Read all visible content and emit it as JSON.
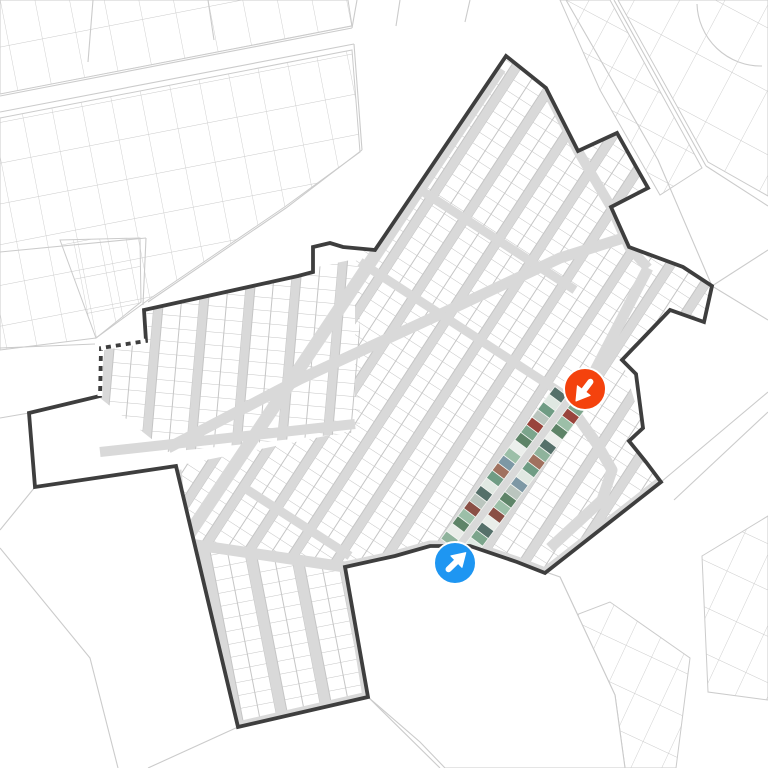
{
  "canvas": {
    "w": 768,
    "h": 768
  },
  "colors": {
    "bg": "#ffffff",
    "outside_line": "#cbcbcb",
    "parcel_line": "#c5c5c5",
    "street": "#d9d9d9",
    "boundary": "#3e3e3e",
    "marker_red": "#f4420d",
    "marker_blue": "#1e96f2",
    "photo_sep": "#f2f4f1"
  },
  "background": {
    "roads": [
      {
        "pts": [
          [
            0,
            96
          ],
          [
            352,
            28
          ]
        ]
      },
      {
        "pts": [
          [
            0,
            112
          ],
          [
            354,
            44
          ]
        ]
      },
      {
        "pts": [
          [
            93,
            0
          ],
          [
            88,
            62
          ]
        ]
      },
      {
        "pts": [
          [
            208,
            0
          ],
          [
            214,
            40
          ]
        ]
      },
      {
        "pts": [
          [
            352,
            28
          ],
          [
            357,
            0
          ]
        ]
      },
      {
        "pts": [
          [
            354,
            44
          ],
          [
            362,
            150
          ]
        ]
      },
      {
        "pts": [
          [
            362,
            150
          ],
          [
            286,
            208
          ],
          [
            148,
            302
          ]
        ]
      },
      {
        "pts": [
          [
            566,
            0
          ],
          [
            658,
            160
          ],
          [
            712,
            286
          ]
        ]
      },
      {
        "pts": [
          [
            614,
            0
          ],
          [
            706,
            166
          ]
        ]
      },
      {
        "pts": [
          [
            706,
            166
          ],
          [
            768,
            206
          ]
        ]
      },
      {
        "pts": [
          [
            712,
            286
          ],
          [
            768,
            320
          ]
        ]
      },
      {
        "pts": [
          [
            712,
            286
          ],
          [
            768,
            250
          ]
        ]
      },
      {
        "pts": [
          [
            661,
            482
          ],
          [
            768,
            392
          ]
        ]
      },
      {
        "pts": [
          [
            674,
            500
          ],
          [
            768,
            412
          ]
        ]
      },
      {
        "pts": [
          [
            560,
            577
          ],
          [
            615,
            695
          ],
          [
            625,
            768
          ]
        ]
      },
      {
        "pts": [
          [
            368,
            697
          ],
          [
            440,
            768
          ]
        ]
      },
      {
        "pts": [
          [
            238,
            727
          ],
          [
            148,
            768
          ]
        ]
      },
      {
        "pts": [
          [
            0,
            252
          ],
          [
            146,
            238
          ]
        ]
      },
      {
        "pts": [
          [
            146,
            238
          ],
          [
            143,
            305
          ]
        ]
      },
      {
        "pts": [
          [
            0,
            348
          ],
          [
            95,
            344
          ]
        ]
      },
      {
        "pts": [
          [
            0,
            530
          ],
          [
            35,
            487
          ]
        ]
      },
      {
        "pts": [
          [
            0,
            548
          ],
          [
            90,
            658
          ],
          [
            118,
            768
          ]
        ]
      },
      {
        "pts": [
          [
            29,
            413
          ],
          [
            0,
            418
          ]
        ]
      },
      {
        "pts": [
          [
            400,
            0
          ],
          [
            396,
            26
          ]
        ]
      },
      {
        "pts": [
          [
            470,
            0
          ],
          [
            465,
            22
          ]
        ]
      }
    ],
    "arcs": [
      {
        "d": "M 697 4 A 64 64 0 0 0 762 66"
      }
    ],
    "patches": [
      {
        "poly": [
          [
            0,
            0
          ],
          [
            348,
            0
          ],
          [
            352,
            26
          ],
          [
            0,
            94
          ]
        ],
        "rot": -11,
        "cw": 34,
        "ch": 46
      },
      {
        "poly": [
          [
            0,
            118
          ],
          [
            352,
            50
          ],
          [
            360,
            152
          ],
          [
            286,
            206
          ],
          [
            148,
            300
          ],
          [
            96,
            338
          ],
          [
            0,
            350
          ]
        ],
        "rot": -11,
        "cw": 30,
        "ch": 40
      },
      {
        "poly": [
          [
            560,
            0
          ],
          [
            610,
            0
          ],
          [
            702,
            168
          ],
          [
            660,
            195
          ],
          [
            600,
            90
          ]
        ],
        "rot": 28,
        "cw": 26,
        "ch": 38
      },
      {
        "poly": [
          [
            618,
            0
          ],
          [
            768,
            0
          ],
          [
            768,
            196
          ],
          [
            708,
            162
          ]
        ],
        "rot": 28,
        "cw": 40,
        "ch": 56
      },
      {
        "poly": [
          [
            500,
            644
          ],
          [
            610,
            602
          ],
          [
            690,
            658
          ],
          [
            676,
            768
          ],
          [
            505,
            768
          ]
        ],
        "rot": 25,
        "cw": 28,
        "ch": 40
      },
      {
        "poly": [
          [
            702,
            556
          ],
          [
            768,
            516
          ],
          [
            768,
            700
          ],
          [
            708,
            692
          ]
        ],
        "rot": 25,
        "cw": 30,
        "ch": 42
      },
      {
        "poly": [
          [
            60,
            240
          ],
          [
            140,
            238
          ],
          [
            141,
            302
          ],
          [
            96,
            338
          ]
        ],
        "rot": -11,
        "cw": 26,
        "ch": 36
      }
    ],
    "outlined": [
      {
        "poly": [
          [
            345,
            567
          ],
          [
            430,
            546
          ],
          [
            470,
            546
          ],
          [
            517,
            562
          ],
          [
            560,
            577
          ],
          [
            615,
            695
          ],
          [
            625,
            768
          ],
          [
            445,
            768
          ],
          [
            420,
            742
          ],
          [
            368,
            697
          ]
        ]
      }
    ]
  },
  "site": {
    "boundary": [
      [
        506,
        56
      ],
      [
        546,
        88
      ],
      [
        578,
        151
      ],
      [
        617,
        133
      ],
      [
        648,
        188
      ],
      [
        611,
        207
      ],
      [
        629,
        247
      ],
      [
        683,
        267
      ],
      [
        712,
        286
      ],
      [
        704,
        322
      ],
      [
        670,
        310
      ],
      [
        622,
        360
      ],
      [
        636,
        374
      ],
      [
        643,
        428
      ],
      [
        629,
        441
      ],
      [
        646,
        462
      ],
      [
        661,
        482
      ],
      [
        545,
        573
      ],
      [
        517,
        562
      ],
      [
        470,
        546
      ],
      [
        430,
        546
      ],
      [
        395,
        556
      ],
      [
        345,
        567
      ],
      [
        368,
        697
      ],
      [
        238,
        727
      ],
      [
        176,
        466
      ],
      [
        35,
        487
      ],
      [
        29,
        413
      ],
      [
        100,
        396
      ],
      [
        101,
        348
      ],
      [
        146,
        341
      ],
      [
        144,
        310
      ],
      [
        298,
        276
      ],
      [
        313,
        272
      ],
      [
        313,
        247
      ],
      [
        330,
        243
      ],
      [
        343,
        247
      ],
      [
        375,
        250
      ]
    ],
    "dashed_edges": [
      [
        [
          100,
          396
        ],
        [
          101,
          348
        ]
      ],
      [
        [
          101,
          348
        ],
        [
          146,
          341
        ]
      ]
    ],
    "zones": [
      {
        "name": "zone-left-grid",
        "poly": [
          [
            95,
            340
          ],
          [
            148,
            333
          ],
          [
            146,
            303
          ],
          [
            360,
            258
          ],
          [
            360,
            432
          ],
          [
            168,
            452
          ],
          [
            100,
            398
          ]
        ],
        "rot": 95,
        "across": 45,
        "block": 36,
        "rung": 13
      },
      {
        "name": "zone-bottom-grid",
        "poly": [
          [
            183,
            543
          ],
          [
            347,
            567
          ],
          [
            368,
            697
          ],
          [
            238,
            727
          ]
        ],
        "rot": 79,
        "across": 45,
        "block": 34,
        "rung": 13
      },
      {
        "name": "zone-diagonal-grid",
        "poly": [
          [
            355,
            262
          ],
          [
            506,
            56
          ],
          [
            546,
            88
          ],
          [
            578,
            151
          ],
          [
            617,
            133
          ],
          [
            648,
            188
          ],
          [
            611,
            207
          ],
          [
            629,
            247
          ],
          [
            683,
            267
          ],
          [
            712,
            286
          ],
          [
            704,
            322
          ],
          [
            670,
            310
          ],
          [
            622,
            360
          ],
          [
            643,
            428
          ],
          [
            661,
            482
          ],
          [
            545,
            573
          ],
          [
            345,
            567
          ],
          [
            183,
            543
          ],
          [
            176,
            466
          ],
          [
            355,
            430
          ]
        ],
        "rot": -57,
        "across": 39.5,
        "block": 30,
        "rung": 12.5
      }
    ],
    "streets": [
      {
        "name": "main-avenue",
        "pts": [
          [
            500,
            68
          ],
          [
            183,
            543
          ]
        ],
        "w": 13
      },
      {
        "name": "oblique-avenue",
        "pts": [
          [
            168,
            448
          ],
          [
            300,
            379
          ],
          [
            443,
            313
          ],
          [
            560,
            258
          ],
          [
            636,
            234
          ]
        ],
        "w": 11
      },
      {
        "name": "left-cross-street",
        "pts": [
          [
            100,
            452
          ],
          [
            355,
            424
          ]
        ],
        "w": 10
      },
      {
        "name": "cross-street-upper",
        "pts": [
          [
            405,
            180
          ],
          [
            575,
            290
          ]
        ],
        "w": 9
      },
      {
        "name": "cross-street-middle",
        "pts": [
          [
            360,
            262
          ],
          [
            572,
            400
          ]
        ],
        "w": 9
      },
      {
        "name": "cross-street-lower",
        "pts": [
          [
            243,
            487
          ],
          [
            350,
            556
          ]
        ],
        "w": 9
      },
      {
        "name": "south-road",
        "pts": [
          [
            176,
            470
          ],
          [
            183,
            543
          ],
          [
            345,
            567
          ],
          [
            395,
            556
          ],
          [
            430,
            546
          ],
          [
            470,
            546
          ],
          [
            517,
            562
          ],
          [
            545,
            573
          ],
          [
            661,
            482
          ]
        ],
        "w": 11
      },
      {
        "name": "lobe-ring-road",
        "pts": [
          [
            183,
            543
          ],
          [
            238,
            727
          ],
          [
            368,
            697
          ],
          [
            347,
            567
          ]
        ],
        "w": 11
      },
      {
        "name": "east-boundary-street",
        "pts": [
          [
            546,
            88
          ],
          [
            578,
            151
          ],
          [
            611,
            207
          ],
          [
            629,
            247
          ],
          [
            648,
            268
          ]
        ],
        "w": 10
      },
      {
        "name": "east-curved-road",
        "pts": [
          [
            648,
            268
          ],
          [
            585,
            390
          ],
          [
            574,
            412
          ],
          [
            597,
            444
          ],
          [
            612,
            470
          ],
          [
            602,
            500
          ],
          [
            575,
            525
          ],
          [
            550,
            548
          ]
        ],
        "w": 11
      },
      {
        "name": "photo-street",
        "pts": [
          [
            456,
            550
          ],
          [
            570,
            398
          ]
        ],
        "w": 8
      }
    ]
  },
  "photo_strip": {
    "a": [
      456,
      550
    ],
    "b": [
      570,
      398
    ],
    "depth": 15,
    "offset": 4,
    "count": 20,
    "left_colors": [
      "#8fb39c",
      "#e9ede9",
      "#5e8468",
      "#9cbfa8",
      "#8a4f45",
      "#bac5be",
      "#55706a",
      "#e0e8e2",
      "#6f9c84",
      "#a0715f",
      "#7d98a5",
      "#9cbfa8",
      "#ecefec",
      "#5e8468",
      "#7ca58c",
      "#99443c",
      "#bac5be",
      "#6f9c84",
      "#dfe8e2",
      "#55706a"
    ],
    "right_colors": [
      "#6f9c84",
      "#dfe8e2",
      "#7ca58c",
      "#55706a",
      "#e9ede9",
      "#8a4f45",
      "#9cbfa8",
      "#5e8468",
      "#bac5be",
      "#7d98a5",
      "#e0e8e2",
      "#6f9c84",
      "#a0715f",
      "#8fb39c",
      "#55706a",
      "#ecefec",
      "#5e8468",
      "#9cbfa8",
      "#99443c",
      "#7ca58c"
    ]
  },
  "markers": [
    {
      "name": "red-arrow-marker",
      "cx": 585,
      "cy": 389,
      "r": 21,
      "color": "#f4420d",
      "angle": 127
    },
    {
      "name": "blue-arrow-marker",
      "cx": 455,
      "cy": 563,
      "r": 21,
      "color": "#1e96f2",
      "angle": -44
    }
  ]
}
